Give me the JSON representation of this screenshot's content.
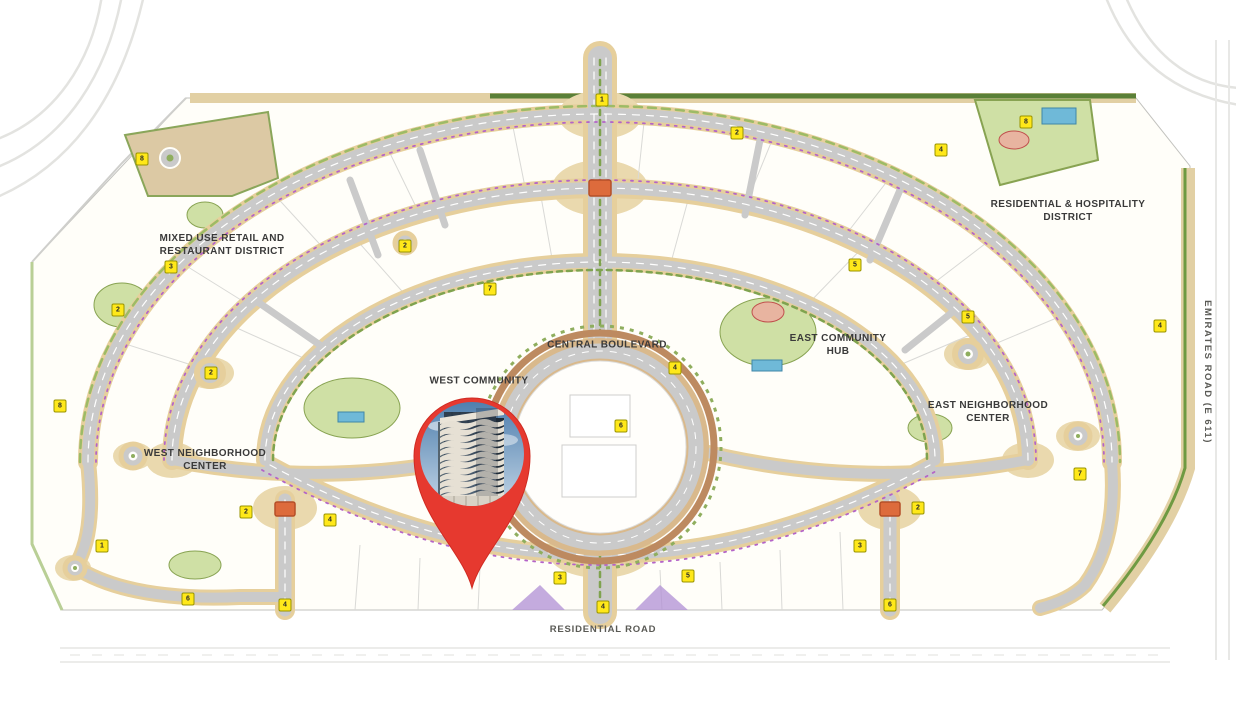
{
  "map": {
    "type": "community-master-plan",
    "labels": {
      "mixed_use": {
        "line1": "MIXED USE RETAIL AND",
        "line2": "RESTAURANT DISTRICT"
      },
      "residential_hospitality": {
        "line1": "RESIDENTIAL & HOSPITALITY",
        "line2": "DISTRICT"
      },
      "central_boulevard": {
        "text": "CENTRAL BOULEVARD"
      },
      "west_community": {
        "text": "WEST COMMUNITY"
      },
      "east_community_hub": {
        "line1": "EAST COMMUNITY",
        "line2": "HUB"
      },
      "west_neighborhood_center": {
        "line1": "WEST NEIGHBORHOOD",
        "line2": "CENTER"
      },
      "east_neighborhood_center": {
        "line1": "EAST NEIGHBORHOOD",
        "line2": "CENTER"
      },
      "emirates_road": {
        "text": "EMIRATES ROAD (E 611)"
      },
      "residential_road": {
        "text": "RESIDENTIAL ROAD"
      }
    },
    "markers": [
      {
        "x": 602,
        "y": 100,
        "n": "1"
      },
      {
        "x": 737,
        "y": 133,
        "n": "2"
      },
      {
        "x": 941,
        "y": 150,
        "n": "4"
      },
      {
        "x": 1026,
        "y": 122,
        "n": "8"
      },
      {
        "x": 142,
        "y": 159,
        "n": "8"
      },
      {
        "x": 171,
        "y": 267,
        "n": "3"
      },
      {
        "x": 118,
        "y": 310,
        "n": "2"
      },
      {
        "x": 1160,
        "y": 326,
        "n": "4"
      },
      {
        "x": 60,
        "y": 406,
        "n": "8"
      },
      {
        "x": 102,
        "y": 546,
        "n": "1"
      },
      {
        "x": 188,
        "y": 599,
        "n": "6"
      },
      {
        "x": 246,
        "y": 512,
        "n": "2"
      },
      {
        "x": 285,
        "y": 605,
        "n": "4"
      },
      {
        "x": 560,
        "y": 578,
        "n": "3"
      },
      {
        "x": 603,
        "y": 607,
        "n": "4"
      },
      {
        "x": 688,
        "y": 576,
        "n": "5"
      },
      {
        "x": 860,
        "y": 546,
        "n": "3"
      },
      {
        "x": 890,
        "y": 605,
        "n": "6"
      },
      {
        "x": 918,
        "y": 508,
        "n": "2"
      },
      {
        "x": 1080,
        "y": 474,
        "n": "7"
      },
      {
        "x": 675,
        "y": 368,
        "n": "4"
      },
      {
        "x": 855,
        "y": 265,
        "n": "5"
      },
      {
        "x": 405,
        "y": 246,
        "n": "2"
      },
      {
        "x": 490,
        "y": 289,
        "n": "7"
      },
      {
        "x": 211,
        "y": 373,
        "n": "2"
      },
      {
        "x": 968,
        "y": 317,
        "n": "5"
      },
      {
        "x": 621,
        "y": 426,
        "n": "6"
      },
      {
        "x": 330,
        "y": 520,
        "n": "4"
      }
    ],
    "colors": {
      "pin_red": "#e6392f",
      "marker_yellow": "#ffe81a",
      "road_gray": "#cacaca",
      "landscape_tan": "#e6cf9c",
      "green": "#8fae5e",
      "pool_blue": "#6fb9d8",
      "bridge_orange": "#dd6b3c",
      "deco_purple": "#b464c8"
    },
    "pin": {
      "kind": "location-pin",
      "content": "high-rise-tower-photo"
    }
  }
}
